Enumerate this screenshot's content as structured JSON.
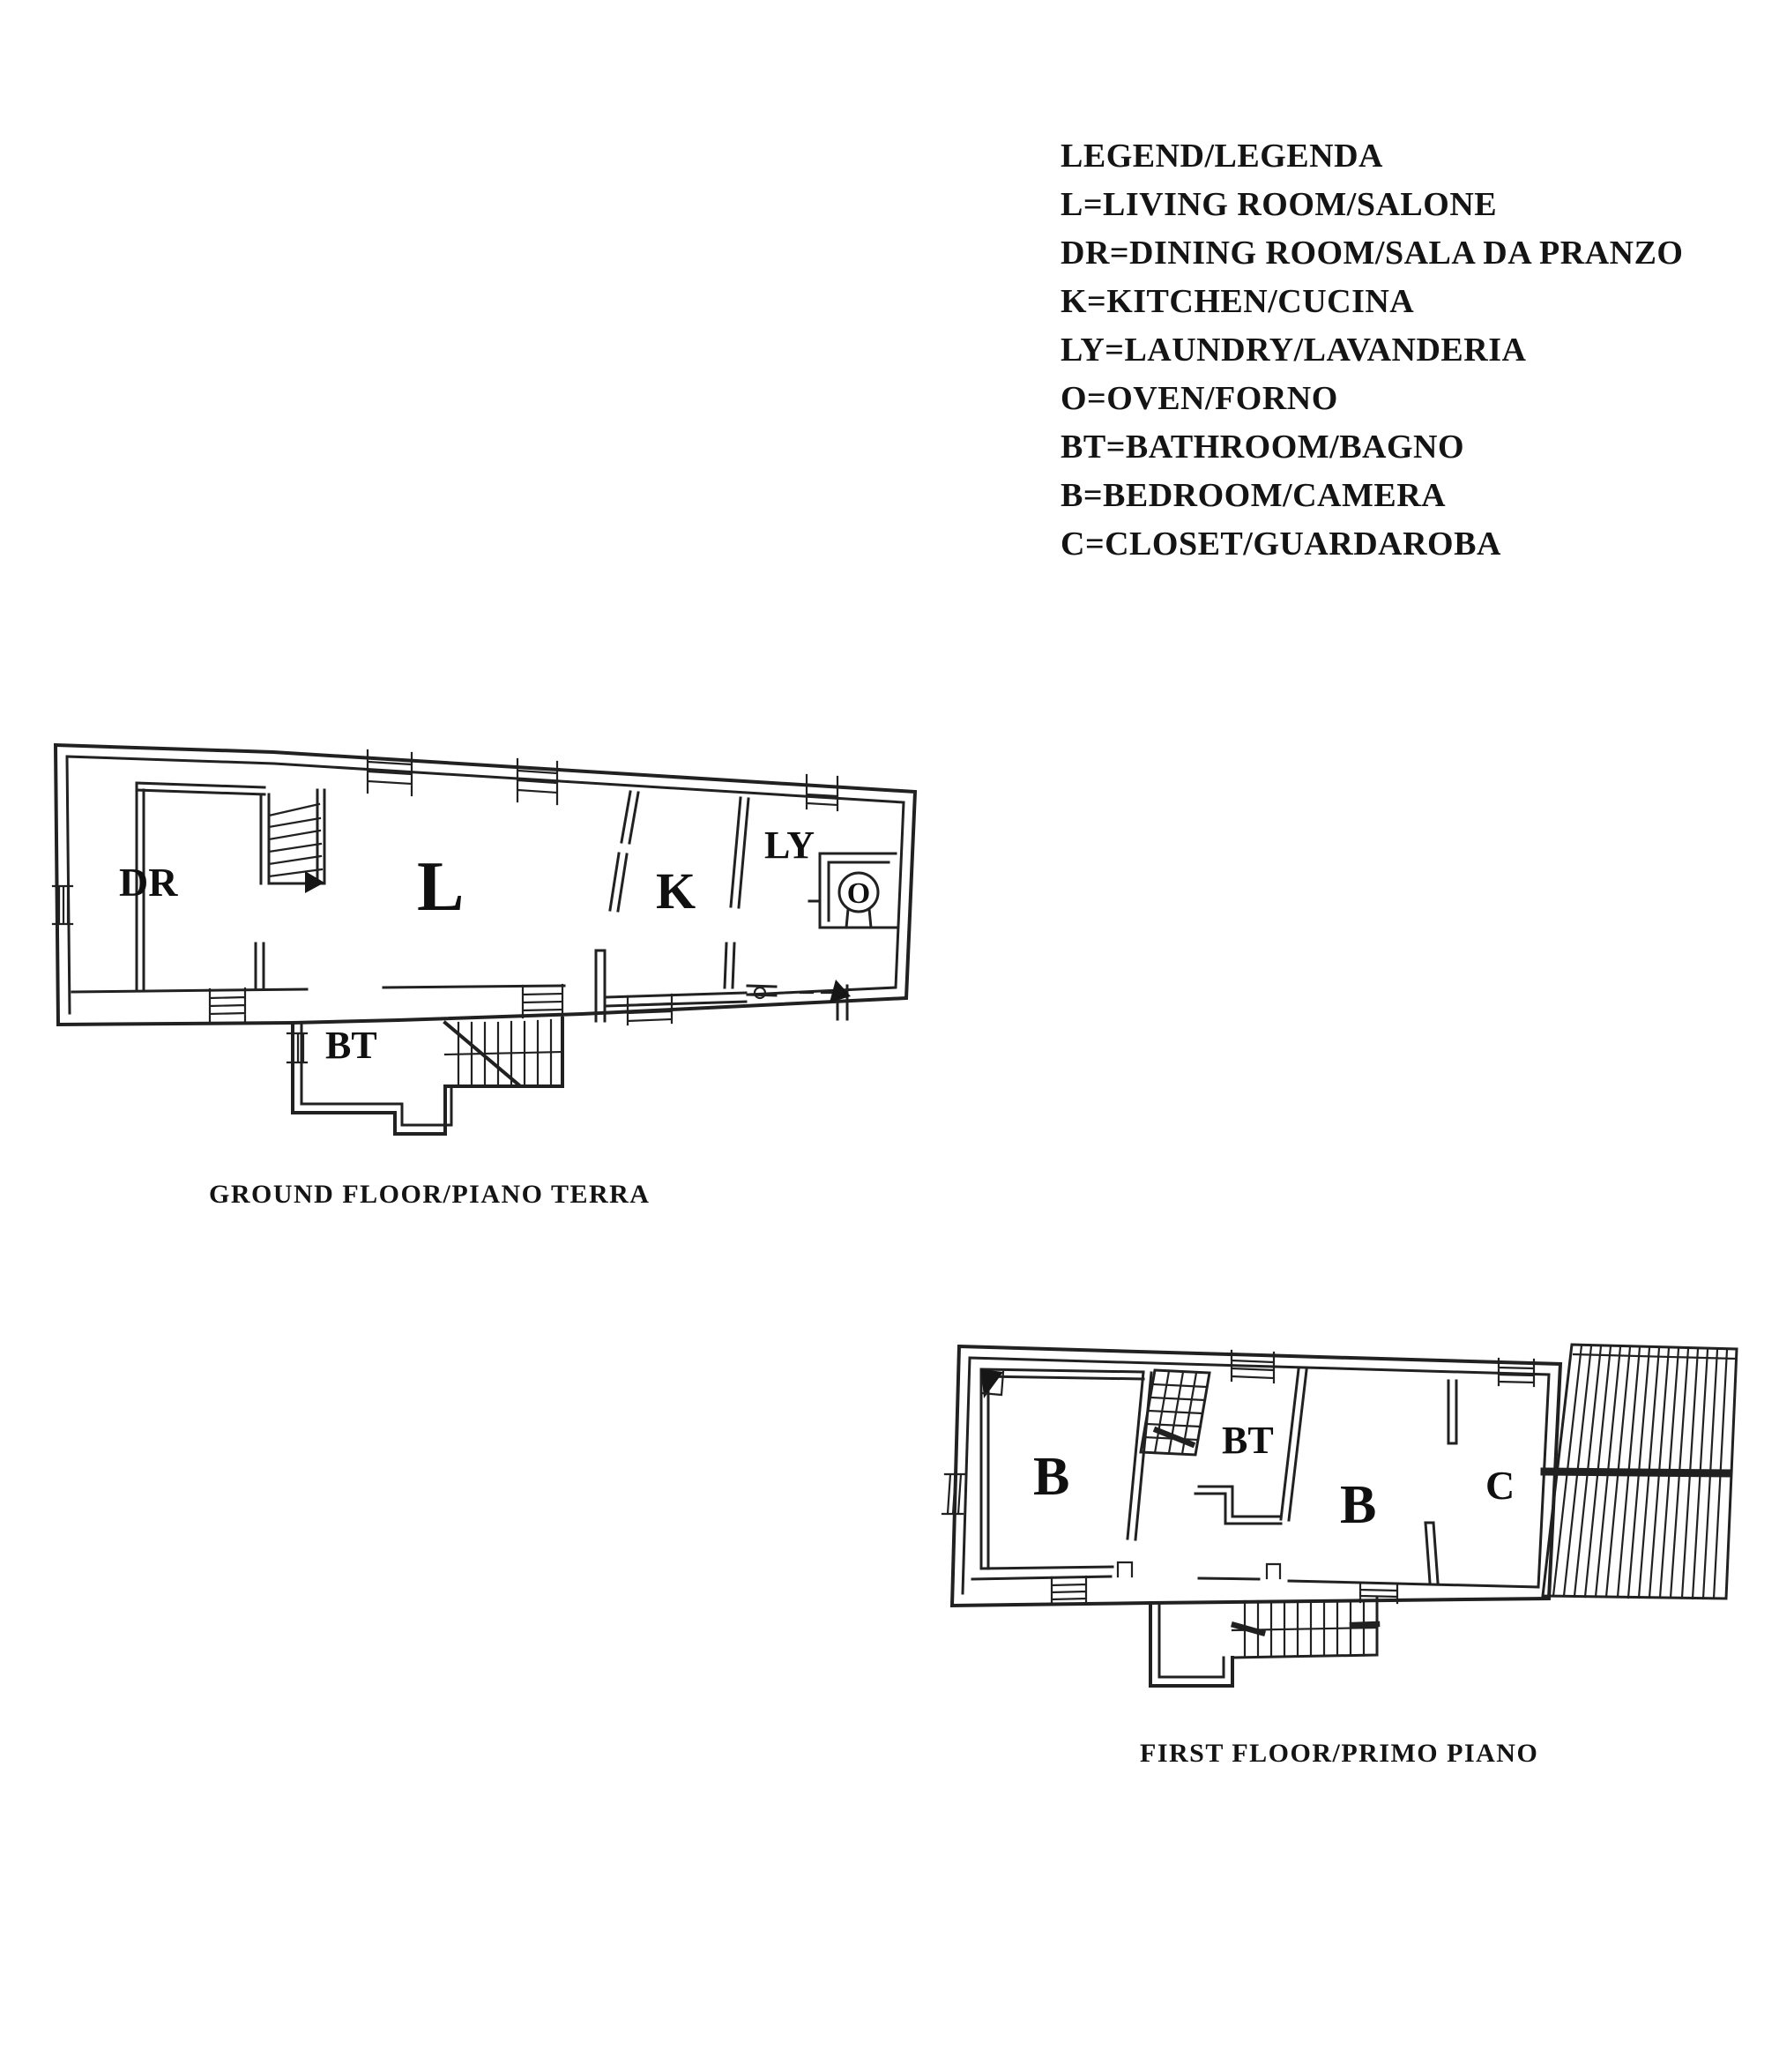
{
  "page": {
    "background_color": "#ffffff",
    "ink_color": "#212121",
    "description_note": "Scanned two-storey house floor plan with bilingual legend"
  },
  "legend": {
    "title": "LEGEND/LEGENDA",
    "entries": [
      "L=LIVING ROOM/SALONE",
      "DR=DINING ROOM/SALA DA PRANZO",
      "K=KITCHEN/CUCINA",
      "LY=LAUNDRY/LAVANDERIA",
      "O=OVEN/FORNO",
      "BT=BATHROOM/BAGNO",
      "B=BEDROOM/CAMERA",
      "C=CLOSET/GUARDAROBA"
    ]
  },
  "ground_floor": {
    "caption": "GROUND FLOOR/PIANO TERRA",
    "labels": {
      "dr": "DR",
      "l": "L",
      "k": "K",
      "ly": "LY",
      "o": "O",
      "bt": "BT"
    }
  },
  "first_floor": {
    "caption": "FIRST FLOOR/PRIMO PIANO",
    "labels": {
      "b1": "B",
      "bt": "BT",
      "b2": "B",
      "c": "C"
    }
  }
}
